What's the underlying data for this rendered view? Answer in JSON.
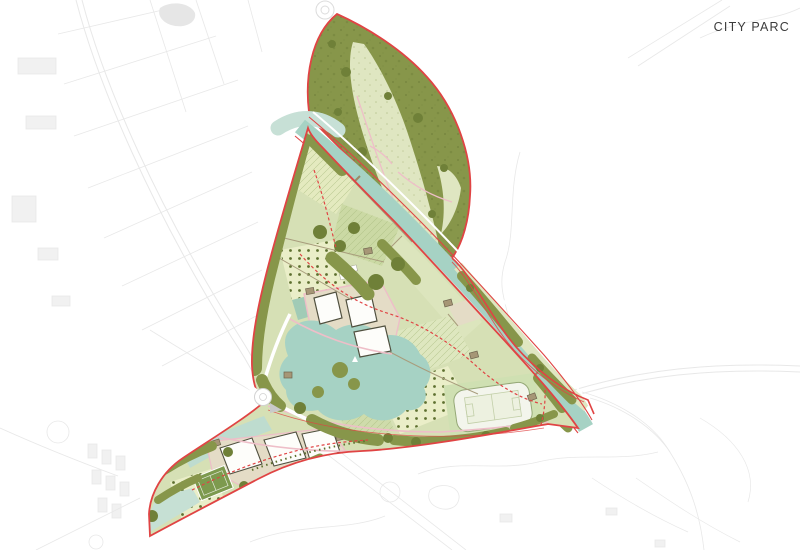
{
  "title": "CITY PARC",
  "colors": {
    "background": "#ffffff",
    "ctx_line": "#e8e8e8",
    "ctx_line_dark": "#dcdcdc",
    "boundary_red": "#e04444",
    "tree_olive": "#87964a",
    "tree_olive_dark": "#6f8038",
    "meadow": "#dfe6c1",
    "field_base": "#d6e0b5",
    "field_pale": "#e4eabf",
    "orchard_base": "#eaeec8",
    "orchard_dot": "#5e7030",
    "water": "#a6d2c4",
    "water_light": "#c7e0d6",
    "water_dark": "#93c6b6",
    "plot_beige": "#e4dcc6",
    "shed_tan": "#a69676",
    "building_fill": "#fdfdfa",
    "building_stroke": "#50503f",
    "path_pink": "#eebec8",
    "plot_line_brown": "#a89c7c",
    "title_color": "#3c3c3c"
  }
}
